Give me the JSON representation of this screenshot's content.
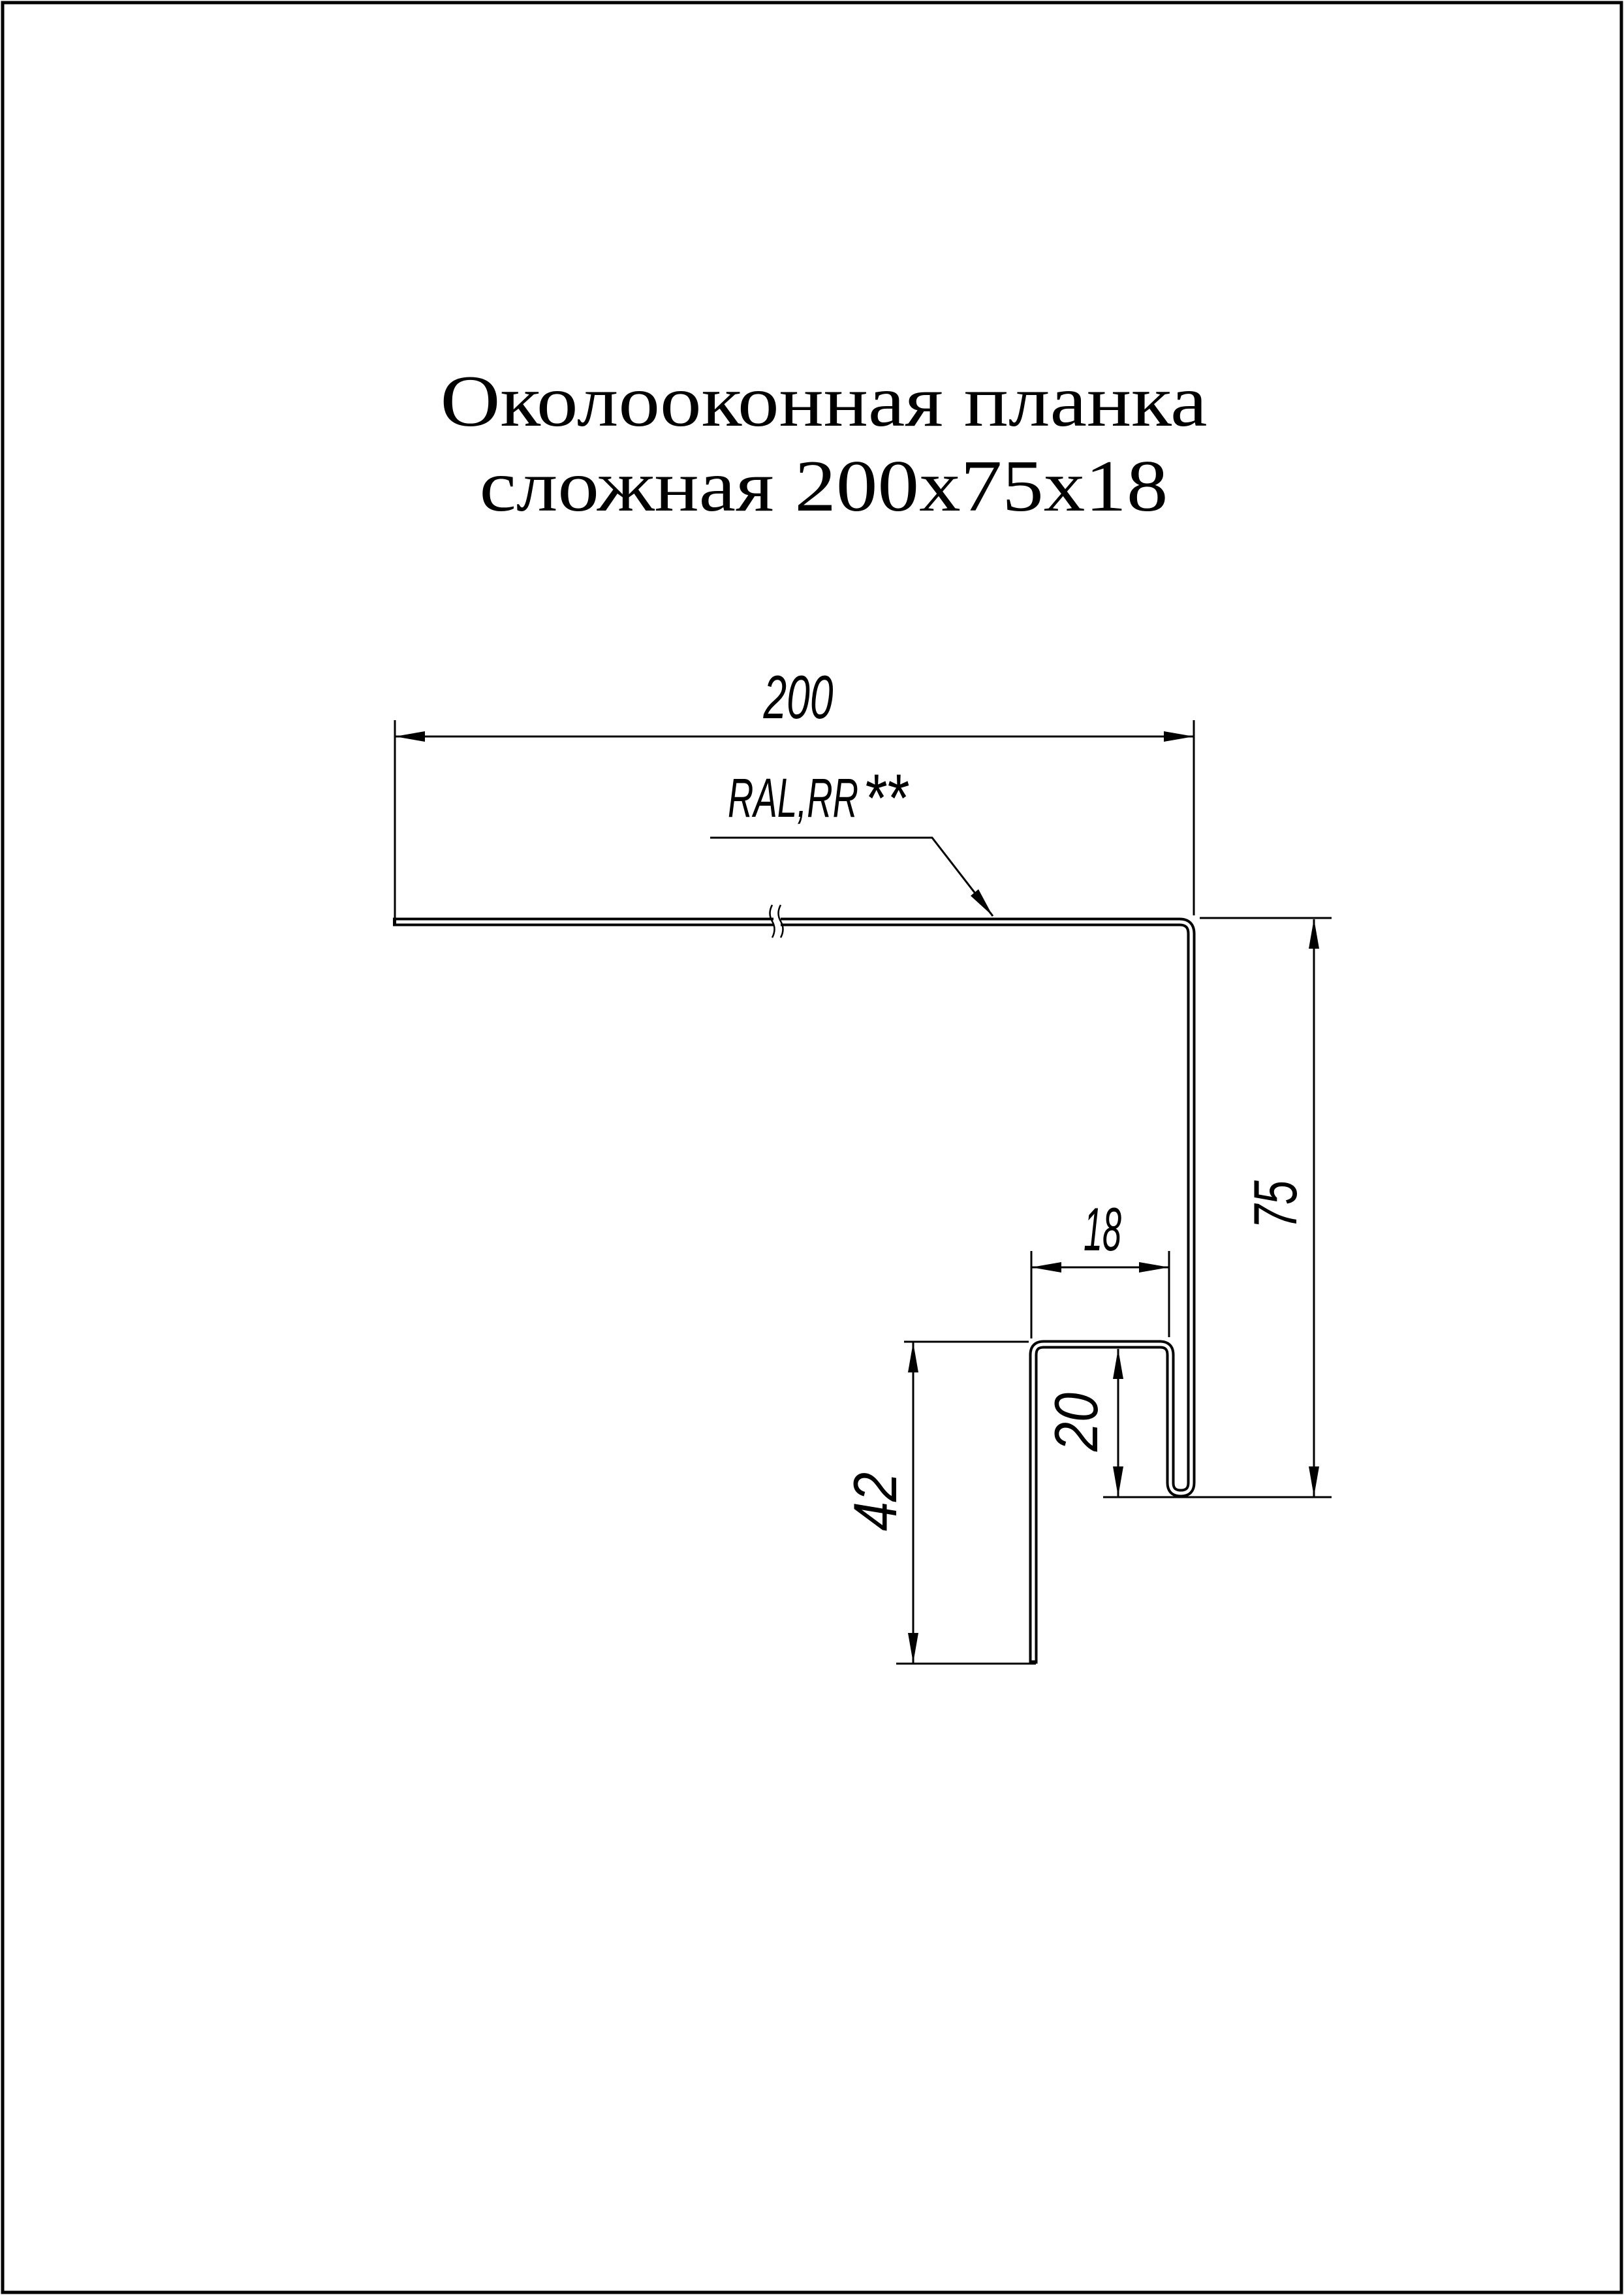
{
  "title": {
    "line1": "Околооконная планка",
    "line2": "сложная 200х75х18"
  },
  "material_label": {
    "text": "RAL,RR",
    "stars": "**"
  },
  "dimensions": {
    "top_width": "200",
    "right_height": "75",
    "shelf_width": "18",
    "hook_depth": "20",
    "leg_height": "42"
  },
  "colors": {
    "line": "#000000",
    "background": "#ffffff"
  }
}
